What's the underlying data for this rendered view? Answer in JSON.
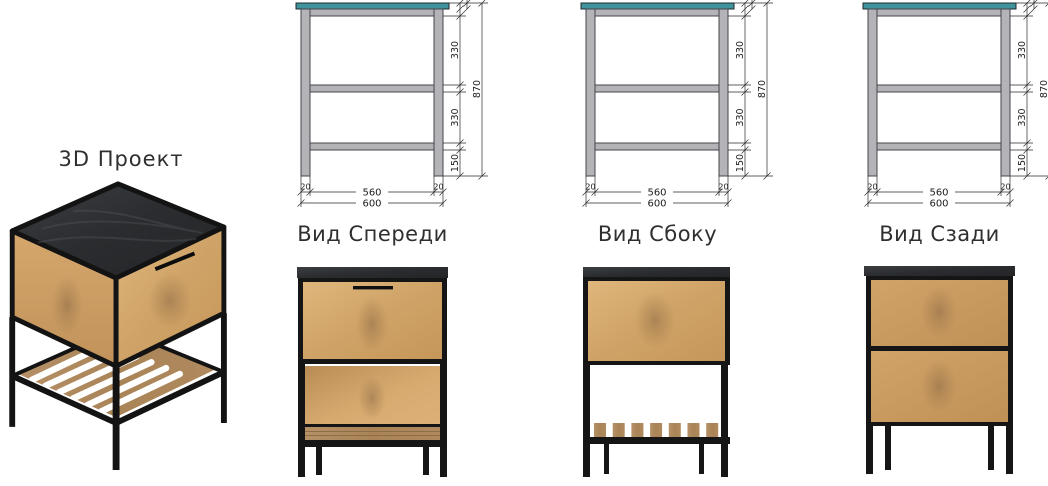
{
  "project": {
    "title": "3D Проект"
  },
  "views": [
    {
      "id": "front",
      "label": "Вид Спереди"
    },
    {
      "id": "side",
      "label": "Вид Сбоку"
    },
    {
      "id": "rear",
      "label": "Вид Сзади"
    }
  ],
  "dimensions": {
    "total_height": "870",
    "upper_segment": "330",
    "middle_segment": "330",
    "leg_segment": "150",
    "inner_width": "560",
    "total_width": "600",
    "left_offset": "20",
    "right_offset": "20"
  },
  "colors": {
    "countertop_teal": "#3e939c",
    "frame_gray": "#b4b4b8",
    "frame_outline": "#46464a",
    "dimension_line": "#2b2b2b",
    "metal_black": "#151515",
    "oak_light": "#e0b67c",
    "oak_dark": "#c6965a",
    "top_slab_dark": "#2e3032",
    "shelf_wood": "#ad8a61",
    "label_text": "#2f2f2f"
  }
}
